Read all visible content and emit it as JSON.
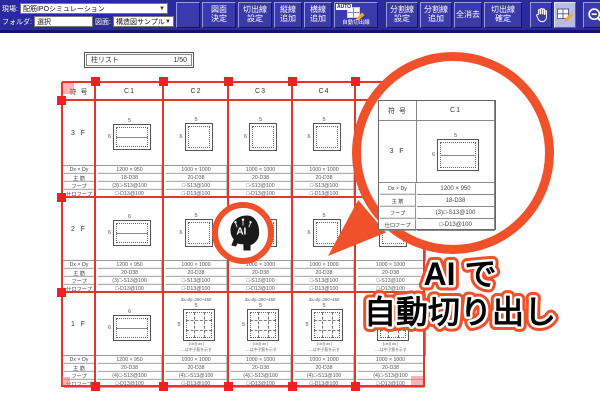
{
  "colors": {
    "toolbar_blue": "#2a2a9c",
    "button_blue": "#3a3aaa",
    "active_tool_bg": "#b9bce9",
    "cut_line_red": "#e2372b",
    "callout_orange": "#f1512a"
  },
  "toolbar": {
    "fields": {
      "site_label": "現場:",
      "site_value": "配筋IPOシミュレーション",
      "folder_label": "フォルダ:",
      "folder_value": "選択",
      "drawing_label": "図面:",
      "drawing_value": "構造図サンプル"
    },
    "buttons": {
      "decide_drawing": "図面\n決定",
      "cutline_setting": "切出線\n設定",
      "vline_add": "縦線\n追加",
      "hline_add": "横線\n追加",
      "auto_tag": "AUTO",
      "auto_cutline": "自動切出線",
      "divline_setting": "分割線\n設定",
      "divline_add": "分割線\n追加",
      "clear_all": "全消去",
      "cutline_confirm": "切出線\n確定"
    }
  },
  "canvas": {
    "title_box": {
      "title": "柱リスト",
      "scale": "1/50"
    },
    "schedule": {
      "corner_label": "符 号",
      "columns": [
        "C1",
        "C2",
        "C3",
        "C4",
        "C5"
      ],
      "row_labels": [
        "Dx × Dy",
        "主 筋",
        "フープ",
        "仕口フープ"
      ],
      "grid_note": "dx=dy=250~450",
      "dim_marks": "⌊dx⌋⌊dx⌋",
      "legend_note": "----は中子筋を示す",
      "sections": [
        {
          "floor": "3 F",
          "cells": [
            {
              "type": "rect",
              "top": "5",
              "left": "6",
              "dims": "1200 × 950",
              "main": "18-D38",
              "hoop": "(3)□-S13@100",
              "joint": "□-D13@100"
            },
            {
              "type": "square",
              "top": "5",
              "left": "6",
              "dims": "1000 × 1000",
              "main": "20-D38",
              "hoop": "□-S13@100",
              "joint": "□-D13@100"
            },
            {
              "type": "square",
              "top": "5",
              "left": "6",
              "dims": "1000 × 1000",
              "main": "20-D38",
              "hoop": "□-S13@100",
              "joint": "□-D13@100"
            },
            {
              "type": "square",
              "top": "5",
              "left": "6",
              "dims": "1000 × 1000",
              "main": "20-D38",
              "hoop": "□-S13@100",
              "joint": "□-D13@100"
            },
            {
              "type": "square",
              "top": "5",
              "left": "6",
              "dims": "1000 × 1000",
              "main": "20-D38",
              "hoop": "□-S13@100",
              "joint": "□-D13@100"
            }
          ]
        },
        {
          "floor": "2 F",
          "cells": [
            {
              "type": "rect",
              "top": "6",
              "left": "6",
              "dims": "1200 × 950",
              "main": "20-D38",
              "hoop": "(3)□-S13@100",
              "joint": "□-D13@100"
            },
            {
              "type": "square",
              "top": "5",
              "left": "6",
              "dims": "1000 × 1000",
              "main": "20-D38",
              "hoop": "□-S13@100",
              "joint": "□-D13@100"
            },
            {
              "type": "square",
              "top": "5",
              "left": "6",
              "dims": "1000 × 1000",
              "main": "20-D38",
              "hoop": "□-S13@100",
              "joint": "□-D13@100"
            },
            {
              "type": "square",
              "top": "5",
              "left": "6",
              "dims": "1000 × 1000",
              "main": "20-D38",
              "hoop": "□-S13@100",
              "joint": "□-D13@100"
            },
            {
              "type": "square",
              "top": "5",
              "left": "6",
              "dims": "1000 × 1000",
              "main": "20-D38",
              "hoop": "□-S13@100",
              "joint": "□-D13@100"
            }
          ]
        },
        {
          "floor": "1 F",
          "cells": [
            {
              "type": "rect",
              "top": "6",
              "left": "6",
              "dims": "1200 × 950",
              "main": "20-D38",
              "hoop": "(4)□-S13@100",
              "joint": "□-D13@100"
            },
            {
              "type": "grid",
              "top": "5",
              "left": "5",
              "dims": "1000 × 1000",
              "main": "20-D38",
              "hoop": "(4)□-S13@100",
              "joint": "□-D13@100"
            },
            {
              "type": "grid",
              "top": "5",
              "left": "5",
              "dims": "1000 × 1000",
              "main": "20-D38",
              "hoop": "(4)□-S13@100",
              "joint": "□-D13@100"
            },
            {
              "type": "grid",
              "top": "5",
              "left": "5",
              "dims": "1000 × 1000",
              "main": "20-D38",
              "hoop": "(4)□-S13@100",
              "joint": "□-D13@100"
            },
            {
              "type": "grid",
              "top": "5",
              "left": "5",
              "dims": "1000 × 1000",
              "main": "20-D38",
              "hoop": "(4)□-S13@100",
              "joint": "□-D13@100"
            }
          ]
        }
      ]
    },
    "ai_badge": {
      "label": "AI"
    },
    "callout": {
      "line1": "AI で",
      "line2": "自動切り出し",
      "table": {
        "corner": "符 号",
        "column": "C1",
        "floor": "3 F",
        "top_count": "5",
        "left_count": "6",
        "rows": [
          {
            "label": "Dx × Dy",
            "value": "1200 × 950"
          },
          {
            "label": "主 筋",
            "value": "18-D38"
          },
          {
            "label": "フープ",
            "value": "(3)□-S13@100"
          },
          {
            "label": "仕口フープ",
            "value": "□-D13@100"
          }
        ]
      }
    }
  }
}
